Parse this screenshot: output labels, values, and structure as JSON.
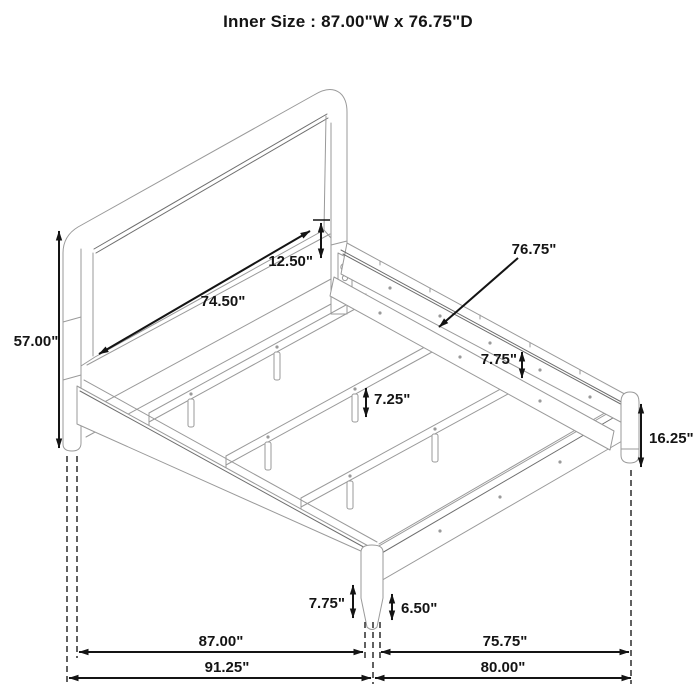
{
  "title": "Inner Size : 87.00\"W x 76.75\"D",
  "labels": {
    "headboard_panel_width": "74.50\"",
    "headboard_panel_offset": "12.50\"",
    "slat_rail_length": "76.75\"",
    "headboard_height": "57.00\"",
    "side_rail_height": "7.75\"",
    "center_leg_height": "7.25\"",
    "footboard_corner_height": "16.25\"",
    "front_leg_height": "7.75\"",
    "front_leg_lower_height": "6.50\"",
    "inner_width": "87.00\"",
    "overall_width": "91.25\"",
    "inner_depth": "75.75\"",
    "overall_depth": "80.00\""
  },
  "colors": {
    "frame-line": "#9a9a9a",
    "pinstripe": "#6e6e6e",
    "dimension-line": "#141414",
    "extension-line": "#3a3a3a"
  }
}
